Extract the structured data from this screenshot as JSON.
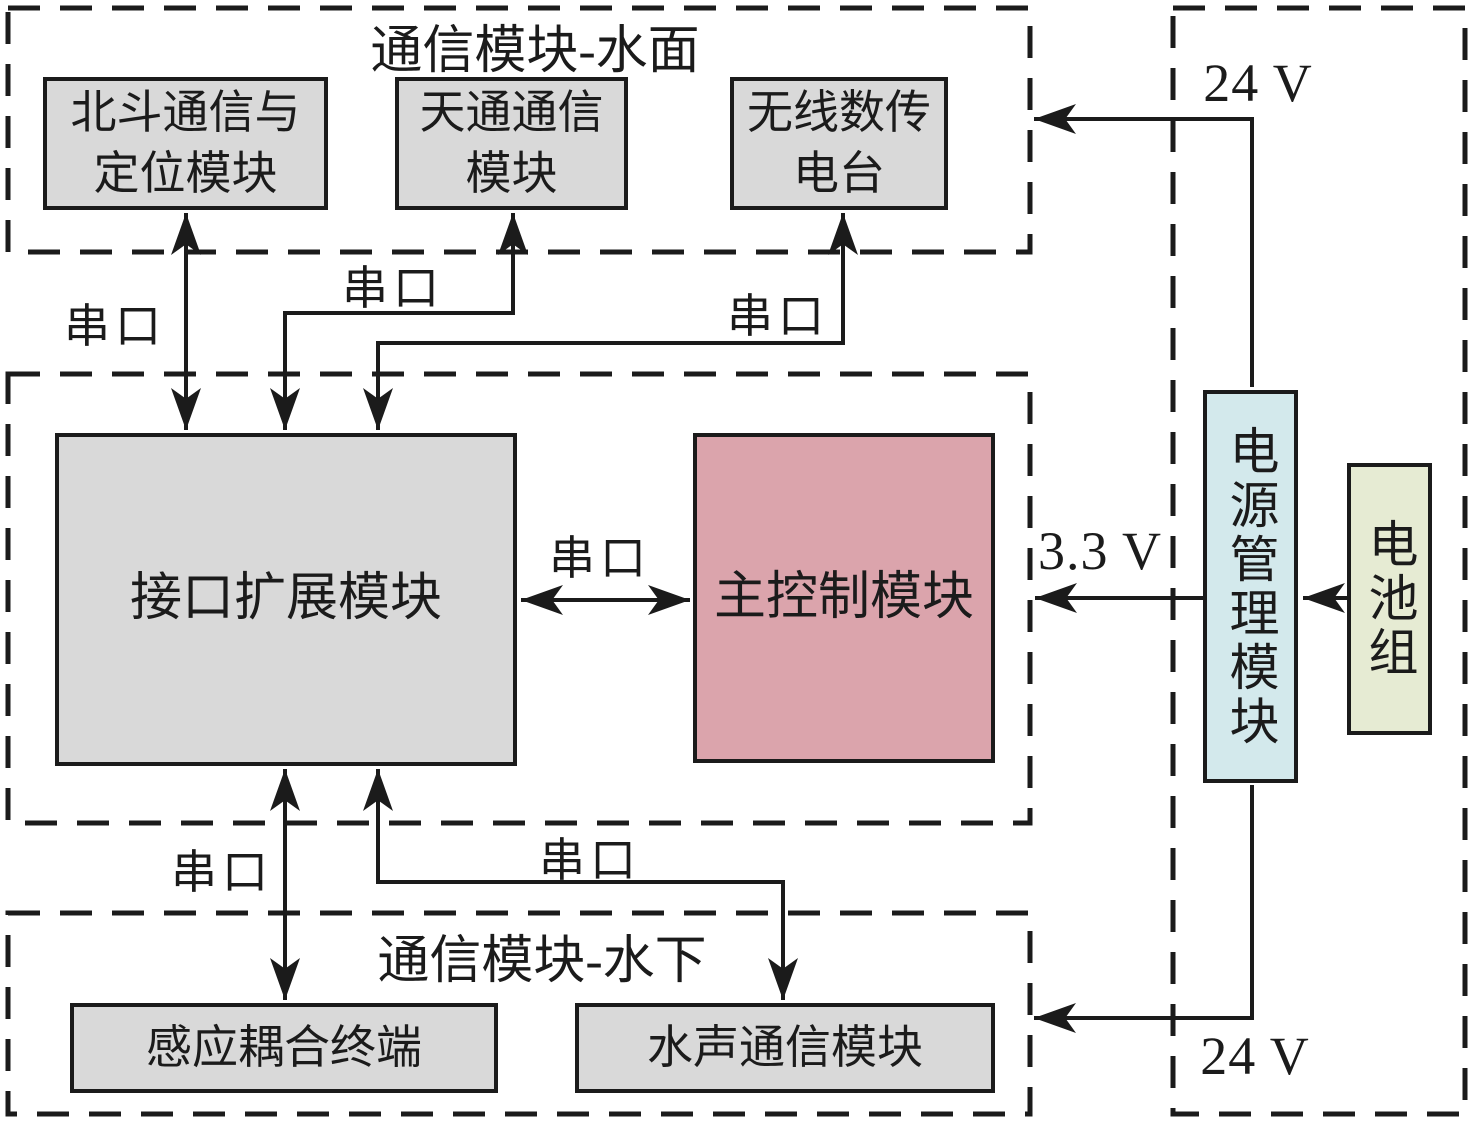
{
  "colors": {
    "line": "#1b1b1b",
    "module-gray": "#d9d9d9",
    "main-control-pink": "#dba4ac",
    "power-mgmt-cyan": "#d3e9ec",
    "battery-green": "#e6ebd3"
  },
  "groups": {
    "surface": {
      "title": "通信模块-水面"
    },
    "underwater": {
      "title": "通信模块-水下"
    }
  },
  "modules": {
    "beidou": {
      "lines": [
        "北斗通信与",
        "定位模块"
      ]
    },
    "tiantong": {
      "lines": [
        "天通通信",
        "模块"
      ]
    },
    "radio": {
      "lines": [
        "无线数传",
        "电台"
      ]
    },
    "interface": {
      "label": "接口扩展模块"
    },
    "main_control": {
      "label": "主控制模块"
    },
    "power_mgmt": {
      "label": "电源管理模块"
    },
    "battery": {
      "label": "电池组"
    },
    "induction": {
      "label": "感应耦合终端"
    },
    "acoustic": {
      "label": "水声通信模块"
    }
  },
  "connection_labels": {
    "serial_beidou": "串口",
    "serial_tiantong": "串口",
    "serial_radio": "串口",
    "serial_main": "串口",
    "serial_induction": "串口",
    "serial_acoustic": "串口",
    "v24_top": "24 V",
    "v24_bottom": "24 V",
    "v33": "3.3 V"
  }
}
